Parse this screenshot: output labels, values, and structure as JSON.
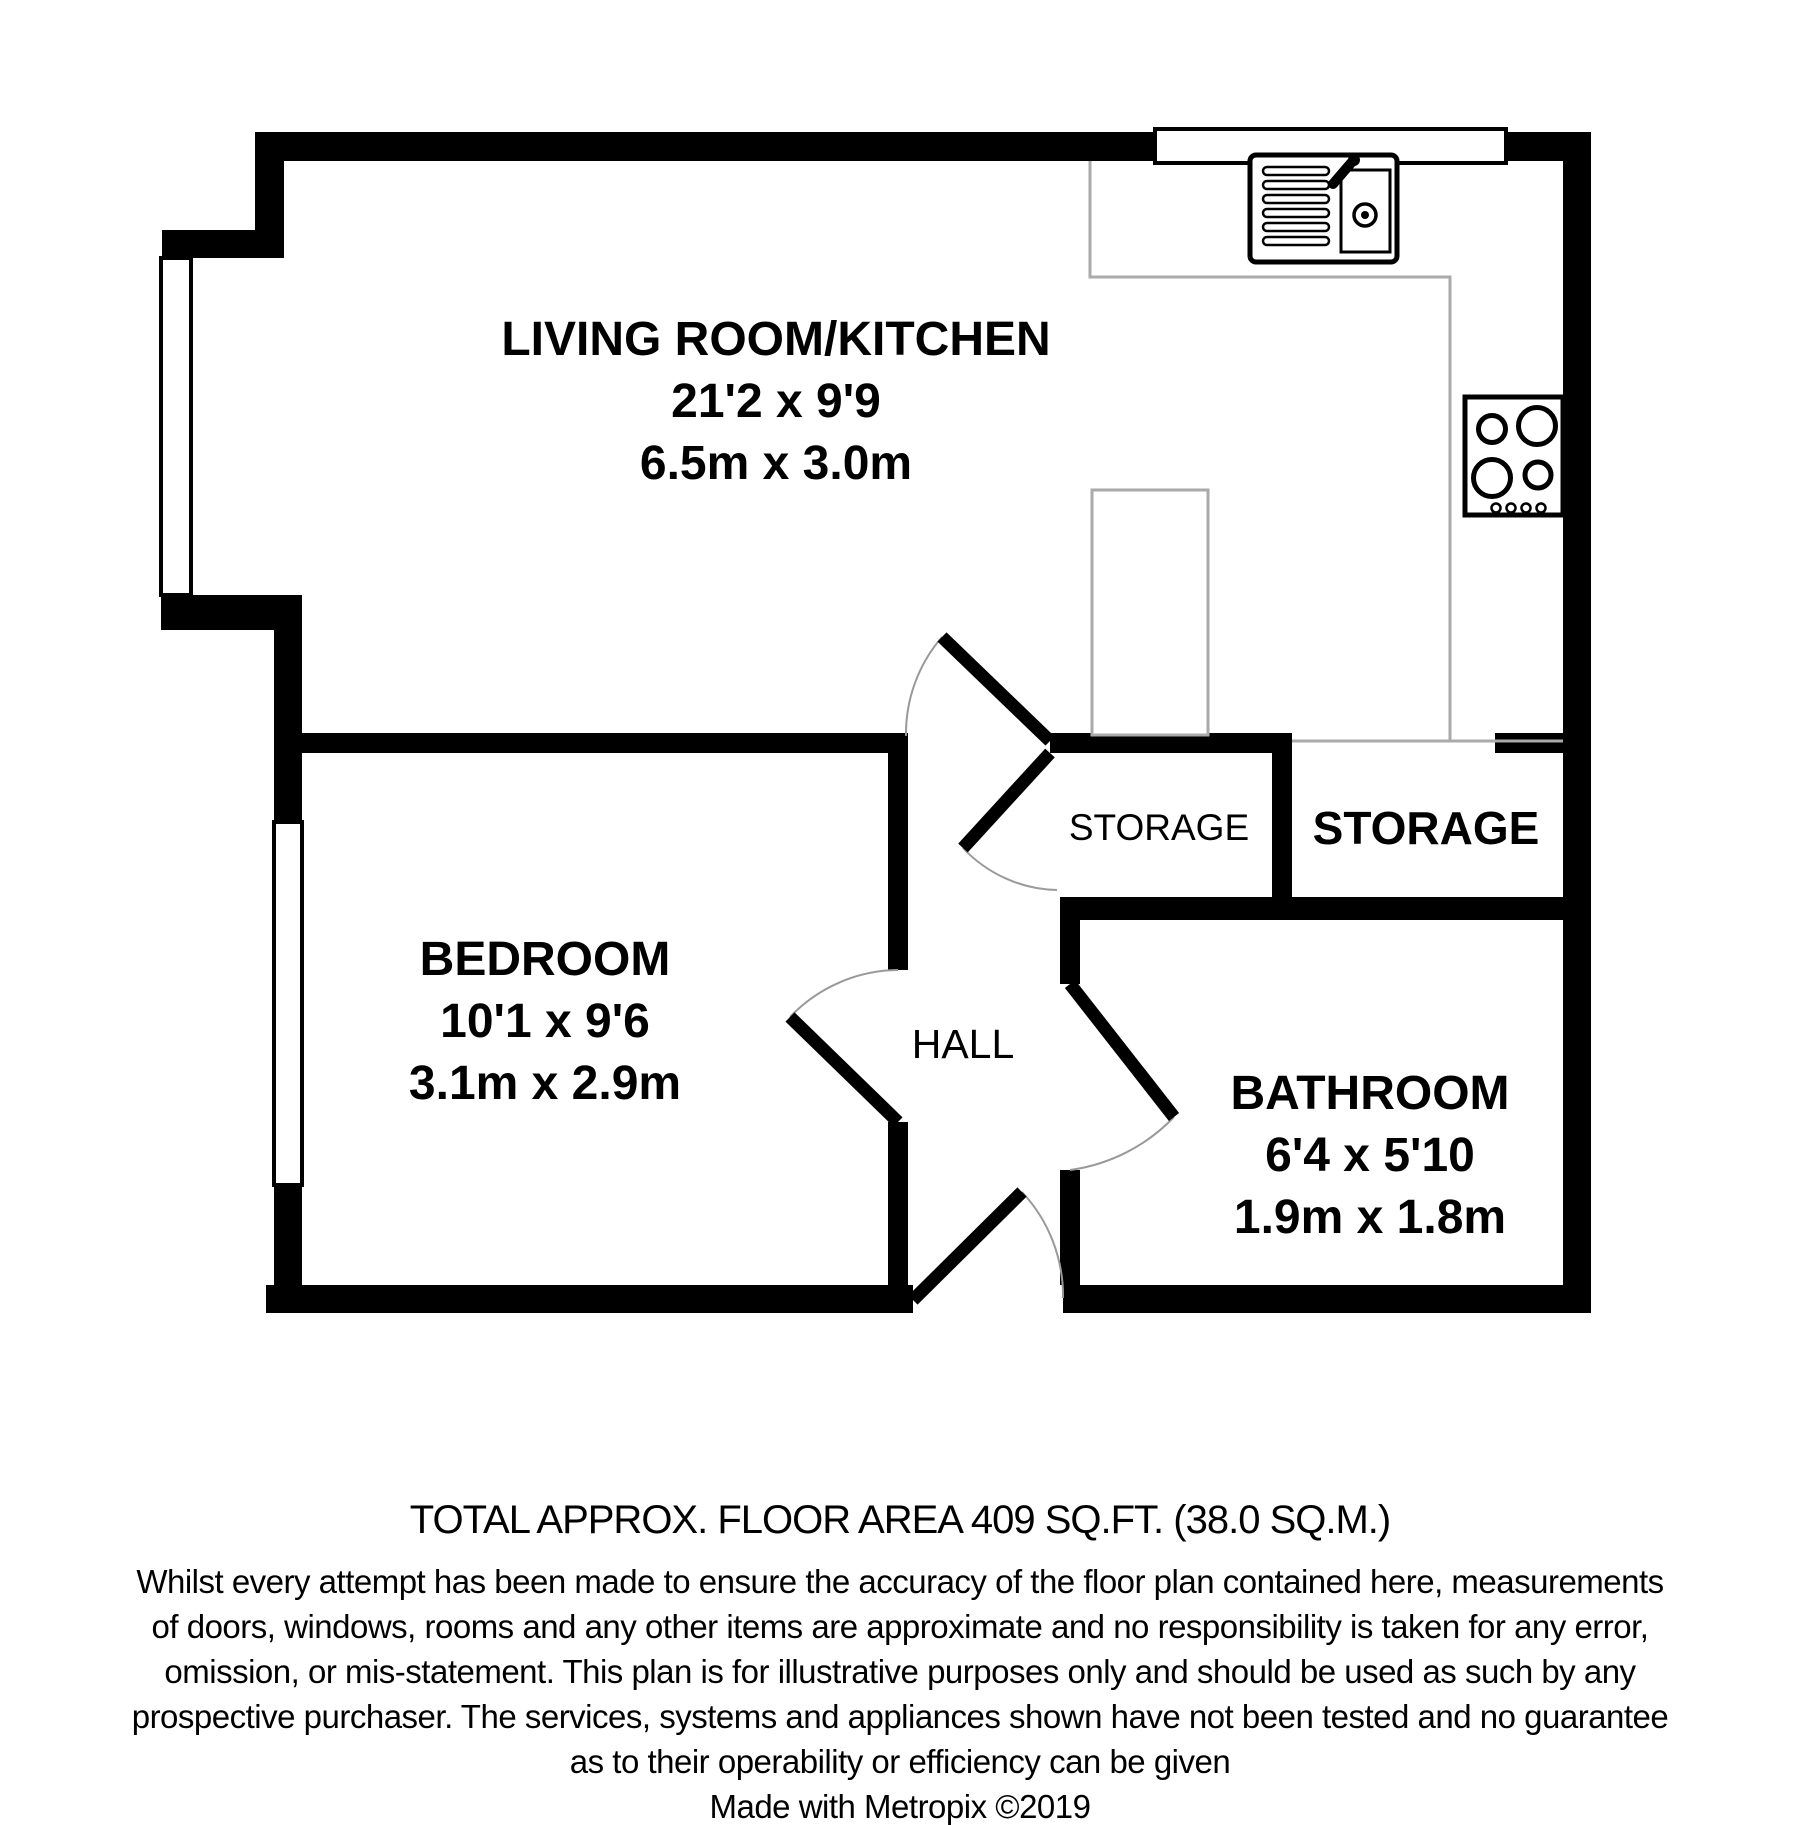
{
  "plan": {
    "rooms": {
      "living": {
        "name": "LIVING ROOM/KITCHEN",
        "imperial": "21'2 x 9'9",
        "metric": "6.5m x 3.0m"
      },
      "bedroom": {
        "name": "BEDROOM",
        "imperial": "10'1 x 9'6",
        "metric": "3.1m x 2.9m"
      },
      "bathroom": {
        "name": "BATHROOM",
        "imperial": "6'4 x 5'10",
        "metric": "1.9m x 1.8m"
      },
      "hall": {
        "name": "HALL"
      },
      "storage_small": {
        "name": "STORAGE"
      },
      "storage_large": {
        "name": "STORAGE"
      }
    },
    "fixtures": {
      "sink": "kitchen-sink-icon",
      "hob": "hob-4-burner-icon",
      "counter": "kitchen-counter-line",
      "cupboard": "tall-cupboard"
    },
    "colors": {
      "wall": "#000000",
      "window": "#ffffff",
      "door_arc": "#999999",
      "counter_line": "#aaaaaa",
      "text": "#000000",
      "background": "#ffffff"
    }
  },
  "footer": {
    "total_area": "TOTAL APPROX. FLOOR AREA 409 SQ.FT. (38.0 SQ.M.)",
    "disclaimer_lines": [
      "Whilst every attempt has been made to ensure the accuracy of the floor plan contained here, measurements",
      "of doors, windows, rooms and any other items are approximate and no responsibility is taken for any error,",
      "omission, or mis-statement. This plan is for illustrative purposes only and should be used as such by any",
      "prospective purchaser. The services, systems and appliances shown have not been tested and no guarantee",
      "as to their operability or efficiency can be given"
    ],
    "credit": "Made with Metropix ©2019"
  }
}
